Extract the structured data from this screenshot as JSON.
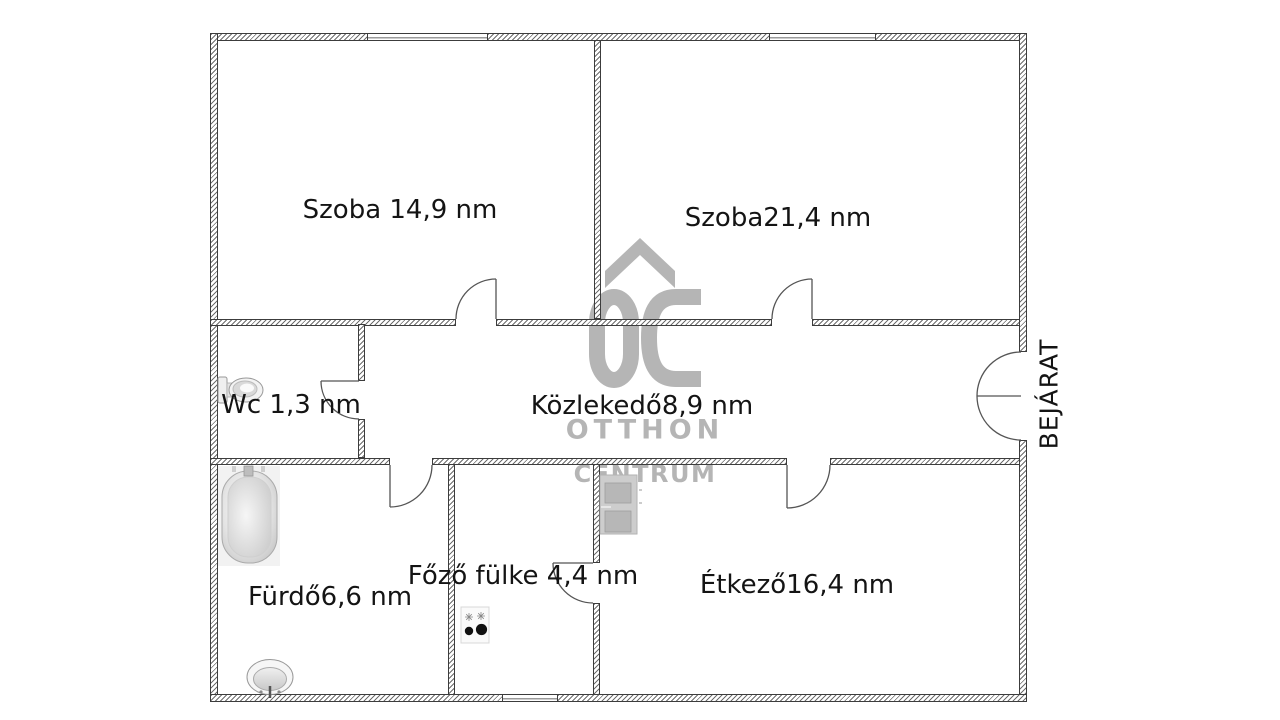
{
  "watermark": {
    "logo": "OC",
    "line1": "OTTHON",
    "line2": "CENTRUM",
    "color": "#b5b5b5"
  },
  "rooms": [
    {
      "name": "szoba-1",
      "label": "Szoba 14,9 nm"
    },
    {
      "name": "szoba-2",
      "label": "Szoba21,4 nm"
    },
    {
      "name": "wc",
      "label": "Wc 1,3 nm"
    },
    {
      "name": "kozlekedo",
      "label": "Közlekedő8,9 nm"
    },
    {
      "name": "furdo",
      "label": "Fürdő6,6 nm"
    },
    {
      "name": "fozo-fulke",
      "label": "Főző fülke 4,4 nm"
    },
    {
      "name": "etkezo",
      "label": "Étkező16,4 nm"
    }
  ],
  "entrance": {
    "label": "BEJÁRAT"
  },
  "fixtures": {
    "toilet": "toilet-icon",
    "bathtub": "bathtub-icon",
    "sink": "sink-icon",
    "stove": "stove-icon",
    "refrigerator": "refrigerator-icon"
  },
  "colors": {
    "wall_line": "#3c3c3c",
    "door_line": "#555555",
    "text": "#141414",
    "watermark": "#b5b5b5"
  }
}
